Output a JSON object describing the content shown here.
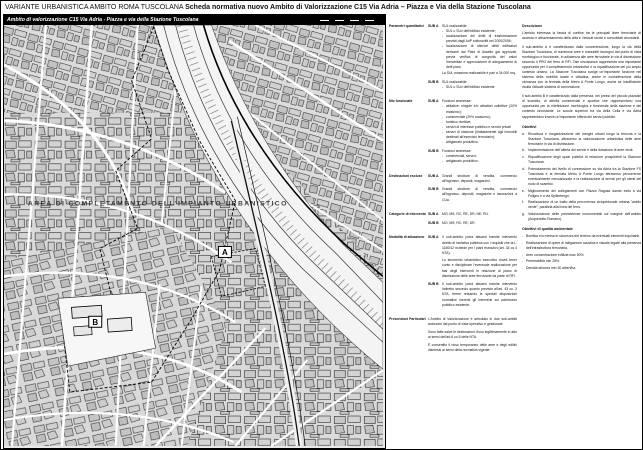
{
  "bullet_char": "-",
  "page": {
    "title_regular": "VARIANTE URBANISTICA AMBITO ROMA TUSCOLANA ",
    "title_bold": "Scheda normativa nuovo Ambito di Valorizzazione C15 Via Adria – Piazza e Via della Stazione Tuscolana"
  },
  "map": {
    "header": "Ambito di valorizzazione C15 Via Adria - Piazza e via della Stazione Tuscolana",
    "area_label": "AREA DI COMPLETAMENTO DELL'IMPIANTO URBANISTICO",
    "marker_a": "A",
    "marker_b": "B"
  },
  "left": {
    "s1": {
      "label": "Parametri quantitativi",
      "a_sub": "SUB A",
      "a_head": "SUL realizzabile:",
      "a_b1": "SUL o SUv dell'edificio esistente;",
      "a_b2": "localizzazione dei diritti di trasformazione previsti dagli AdP sottoscritti nel 2000/2006;",
      "a_b3": "localizzazione di ulteriori diritti edificatori derivanti dai Piani di Assetto già approvati, previa verifica di congruità dei valori immobiliari e approvazione di adeguamento di detti piani.",
      "a_note": "La SUL massima realizzabile è pari a 34.000 mq.",
      "b_sub": "SUB B",
      "b_head": "SUL realizzabile:",
      "b_b1": "SUL o SUv dell'edificio esistente"
    },
    "s2": {
      "label": "Mix funzionale",
      "a_sub": "SUB A",
      "a_head": "Funzioni ammesse:",
      "a_b1": "abitative: singole e/o attrattori collettive (20% massimo);",
      "a_b2": "commerciale (20% massimo);",
      "a_b3": "turistico ricettive;",
      "a_b4": "servizi di interesse pubblico e servizi privati",
      "a_b5": "servizi di stazione (limitatamente agli immobili destinati all'esercizio ferroviario);",
      "a_b6": "artigianato produttivo.",
      "b_sub": "SUB B",
      "b_head": "Funzioni ammesse:",
      "b_b1": "commerciali, servizi;",
      "b_b2": "artigianato produttivo."
    },
    "s3": {
      "label": "Destinazioni escluse",
      "a_sub": "SUB A",
      "a_text": "Grandi strutture di vendita, commercio all'ingrosso, depositi, magazzini.",
      "b_sub": "SUB B",
      "b_text": "Grandi strutture di vendita, commercio all'ingrosso, depositi, magazzini e lavorazioni a CUa."
    },
    "s4": {
      "label": "Categorie di intervento",
      "a_sub": "SUB A",
      "a_text": "MO; MS; RC; RE; DR; NE; RU.",
      "b_sub": "SUB B",
      "b_text": "MO; MS; RC; RE; DR."
    },
    "s5": {
      "label": "Modalità di attuazione",
      "a_sub": "SUB A",
      "a_p1": "Il sub-ambito potrà attuarsi tramite intervento diretto di iniziativa pubblica con i requisiti che la L. 1150/42 richiede per i piani esecutivi (art. 34 co.4 NTA).",
      "a_p2": "Lo strumento urbanistico esecutivo dovrà tener conto e disciplinare l'eventuale realizzazione per fasi degli interventi in relazione al piano di dismissione delle aree ferroviarie da parte di RFI.",
      "b_sub": "SUB B",
      "b_p1": "Il sub-ambito potrà attuarsi tramite intervento indiretto secondo quanto previsto all'art. 43 co. 3 NTA, ferme restando le speciali disposizioni normative inerenti gli interventi sul patrimonio pubblico esistente."
    },
    "s6": {
      "label": "Prescrizioni Particolari",
      "p1": "L'Ambito di Valorizzazione è articolato in due sub-ambiti autonomi dal punto di vista operativo e gestionale.",
      "p2": "Sono fatte salve le destinazioni d'uso legittimamente in atto ai sensi dell'art.6 co.5 delle NTA.",
      "p3": "È consentito il riuso temporaneo delle aree e degli edifici dismessi ai sensi della normativa vigente."
    }
  },
  "right": {
    "desc": {
      "label": "Descrizione",
      "p1": "L'ambito interessa la fascia di confine tra le principali linee ferroviarie di accesso e attraversamento della città e i tessuti storici e consolidati circostanti.",
      "p2": "Il sub-ambito A è caratterizzato dalla concentrazione, lungo la via della Stazione Tuscolana, di numerose aree e manufatti incongrui dal punto di vista morfologico e funzionale, in adiacenza alle aree ferroviarie in via di dismissione secondo il PRG del ferro di RFI. Tale circostanza rappresenta una importante opportunità per il completamento urbanistico e la riqualificazione del più ampio contesto urbano. La Stazione Tuscolana svolge un'importante funzione nel sistema della mobilità locale e cittadina, anche in considerazione della vicinanza con la fermata della Metro A Ponte Lungo, anche se insufficiente risulta l'attuale sistema di connessione.",
      "p3": "Il sub-ambito B è caratterizzato dalla presenza, nei pressi del piccolo piazzale di scambio, di attività commerciali e sportive che rappresentano una opportunità per la ridefinizione morfologica e funzionale della stazione e del contesto circostante. Le scuole superiori tra via della Cella e via Adria rappresentano invece un'importante offerta dei servizi pubblici."
    },
    "obj": {
      "label": "Obiettivi",
      "i1": {
        "m": "a.",
        "t": "Ricucitura e riorganizzazione dei margini urbani lungo la ferrovia e la Stazione Tuscolana, attraverso la valorizzazione urbanistica delle aree ferroviarie in via di dismissione."
      },
      "i2": {
        "m": "b.",
        "t": "Implementazione dell'offerta dei servizi e della dotazione di aree verdi."
      },
      "i3": {
        "m": "c.",
        "t": "Riqualificazione degli spazi pubblici di relazione prospicienti la Stazione Tuscolana."
      },
      "i4": {
        "m": "d.",
        "t": "Potenziamento del livello di connessione su via Adria tra la Stazione FS Tuscolana e la fermata Metro A Ponte Lungo attraverso percorrenze eventualmente meccanizzate e la realizzazione di servizi per gli utenti del nodo di scambio."
      },
      "i5": {
        "m": "e.",
        "t": "Miglioramento dei collegamenti con Piazza Ragusa dando esito a via Foligno e a via Spilimbergo."
      },
      "i6": {
        "m": "f.",
        "t": "Realizzazione di un tratto della percorrenza ciclopedonale urbana \"anello verde\", parallela alla linea del ferro."
      },
      "i7": {
        "m": "g.",
        "t": "Valorizzazione delle preesistenze monumentali sul margine dell'ambito (Acquedotto Romano)."
      }
    },
    "env": {
      "label": "Obiettivi di qualità ambientale",
      "b1": "Bonifica e/o messa in sicurezza del terreno da eventuali elementi inquinanti.",
      "b2": "Realizzazione di opere di mitigazione acustica e visuale legate alla presenza dell'infrastruttura ferroviaria.",
      "b3": "Aree concentrazione edilizia max 50%.",
      "b4": "Permeabilità min 25%.",
      "b5": "Densità arborea min 30 alberi/ha."
    }
  }
}
